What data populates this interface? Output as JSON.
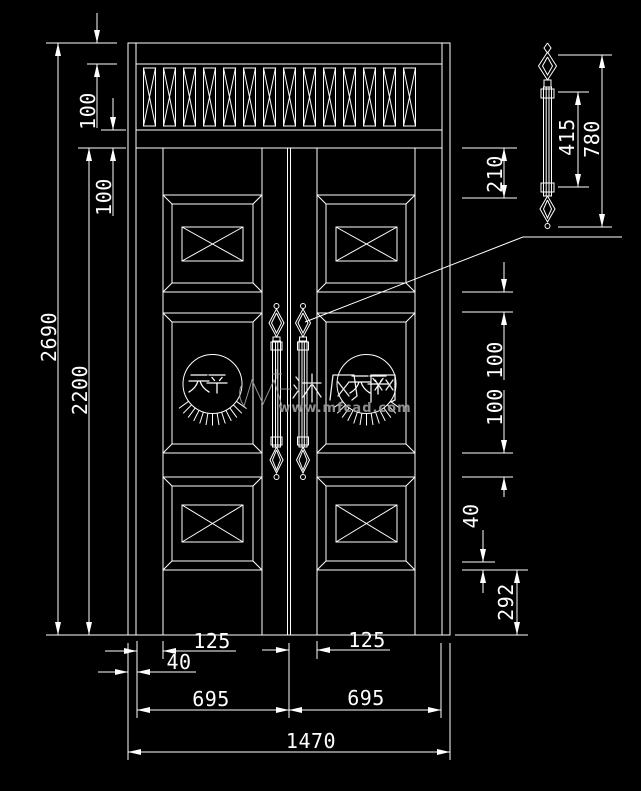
{
  "colors": {
    "background": "#000000",
    "line": "#ffffff",
    "watermark": "#9a9a9a"
  },
  "door": {
    "medallion_text_left": "天平",
    "medallion_text_right": "天平",
    "louver_count": 14,
    "panels_per_leaf": 3
  },
  "watermark": {
    "brand": "沐风网",
    "url": "www.mfcad.com"
  },
  "dims": {
    "total_height": "2690",
    "leaf_height": "2200",
    "top_rail": "100",
    "transom_bottom_rail": "100",
    "handle_top_offset": "210",
    "handle_grip_length": "415",
    "handle_total_length": "780",
    "rail_top_mid": "100",
    "rail_mid_bottom": "100",
    "panel_bevel": "40",
    "bottom_rail": "292",
    "stile_left": "125",
    "stile_right": "125",
    "frame_edge": "40",
    "leaf_width_left": "695",
    "leaf_width_right": "695",
    "total_width": "1470"
  }
}
